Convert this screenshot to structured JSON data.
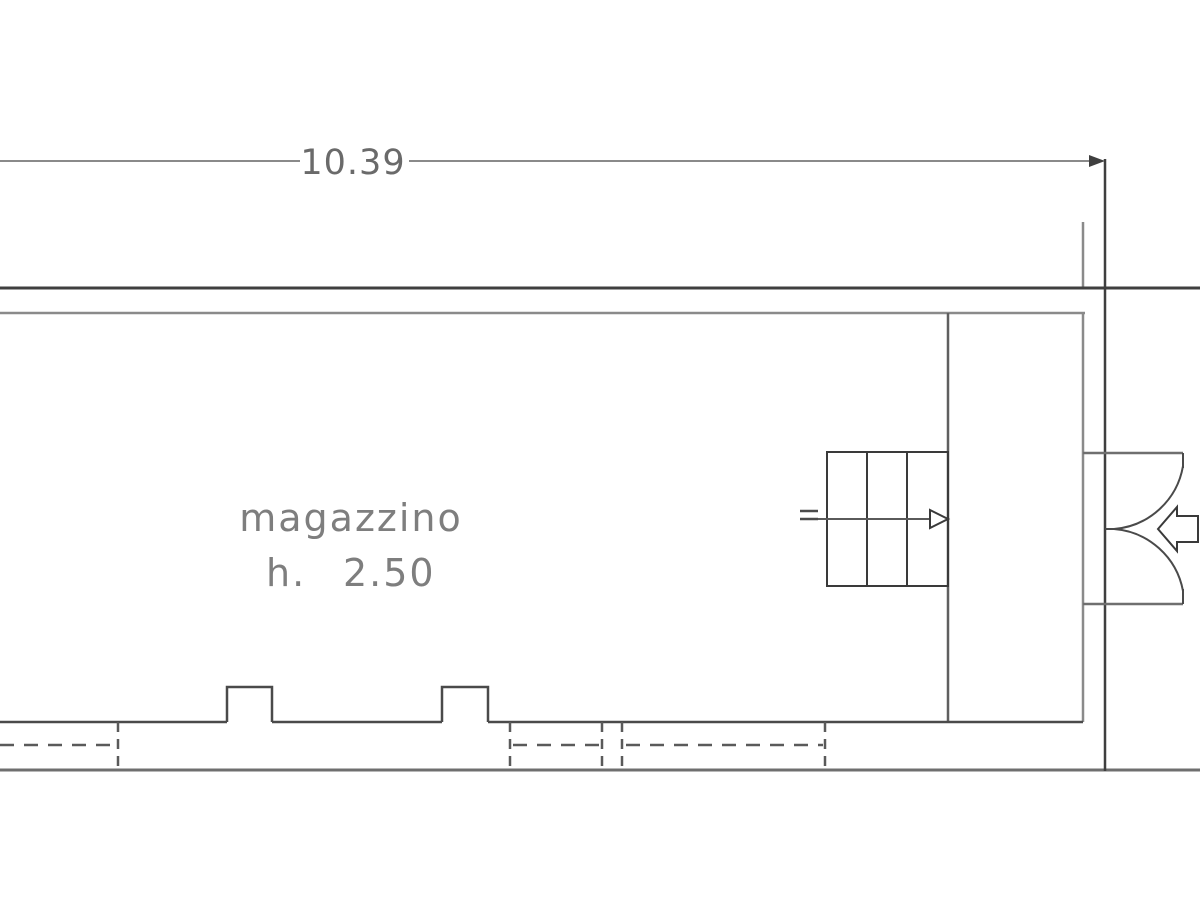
{
  "floor_plan": {
    "type": "architectural-floor-plan",
    "overall_width_dimension": "10.39",
    "room": {
      "name": "magazzino",
      "height_label": "h.",
      "height_value": "2.50"
    },
    "symbols": [
      "staircase-icon",
      "stair-direction-arrow-icon",
      "double-swing-door-icon",
      "entrance-arrow-icon",
      "dashed-window-opening",
      "wall-pilaster"
    ],
    "colors": {
      "background": "#ffffff",
      "line_dark": "#3f3f3f",
      "line_medium": "#8a8a8a",
      "line_soft": "#5f5f5f",
      "text": "#7e7e7e"
    }
  }
}
